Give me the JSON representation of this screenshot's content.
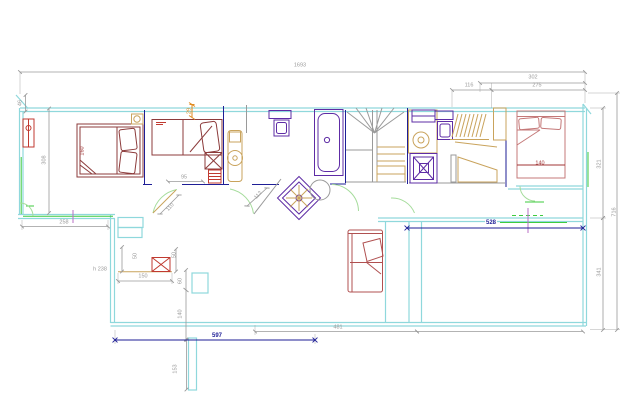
{
  "document": {
    "type": "architectural-floor-plan",
    "background": "#ffffff"
  },
  "palette": {
    "cyan": "#8fd8dc",
    "navy": "#1e1e96",
    "purple": "#5e2ca5",
    "maroon": "#8c3b3b",
    "bedpink": "#c47878",
    "red": "#c03a30",
    "tan": "#c9a35c",
    "tan_fill": "#e3d0a0",
    "green": "#3ecb3e",
    "green_arc": "#a5dc9b",
    "gray": "#9a9a9a",
    "orange": "#e08a1e",
    "magenta": "#b86fc6",
    "brown": "#7c3a2e",
    "sofa": "#b05050",
    "dark_red_text": "#a03535"
  },
  "dimensions": [
    {
      "text": "1693",
      "x": 300,
      "y": 66,
      "rot": 0,
      "color": "gray"
    },
    {
      "text": "302",
      "x": 533,
      "y": 78,
      "rot": 0,
      "color": "gray"
    },
    {
      "text": "116",
      "x": 469,
      "y": 86,
      "rot": 0,
      "color": "gray"
    },
    {
      "text": "275",
      "x": 537,
      "y": 86,
      "rot": 0,
      "color": "gray"
    },
    {
      "text": "46",
      "x": 21,
      "y": 103,
      "rot": -90,
      "color": "gray"
    },
    {
      "text": "308",
      "x": 45,
      "y": 160,
      "rot": -90,
      "color": "gray"
    },
    {
      "text": "160",
      "x": 83,
      "y": 151,
      "rot": -90,
      "color": "dark_red_text"
    },
    {
      "text": "29",
      "x": 190,
      "y": 111,
      "rot": -90,
      "color": "orange"
    },
    {
      "text": "95",
      "x": 184,
      "y": 178,
      "rot": 0,
      "color": "gray"
    },
    {
      "text": "110",
      "x": 171,
      "y": 208,
      "rot": -48,
      "color": "gray"
    },
    {
      "text": "112",
      "x": 259,
      "y": 196,
      "rot": -48,
      "color": "gray"
    },
    {
      "text": "258",
      "x": 64,
      "y": 223,
      "rot": 0,
      "color": "gray"
    },
    {
      "text": "h 238",
      "x": 100,
      "y": 270,
      "rot": 0,
      "color": "gray"
    },
    {
      "text": "50",
      "x": 136,
      "y": 256,
      "rot": -90,
      "color": "gray"
    },
    {
      "text": "50",
      "x": 175,
      "y": 255,
      "rot": -90,
      "color": "gray"
    },
    {
      "text": "150",
      "x": 143,
      "y": 277,
      "rot": 0,
      "color": "gray"
    },
    {
      "text": "60",
      "x": 181,
      "y": 281,
      "rot": -90,
      "color": "gray"
    },
    {
      "text": "140",
      "x": 181,
      "y": 314,
      "rot": -90,
      "color": "gray"
    },
    {
      "text": "153",
      "x": 176,
      "y": 369,
      "rot": -90,
      "color": "gray"
    },
    {
      "text": "597",
      "x": 217,
      "y": 336,
      "rot": 0,
      "color": "navy",
      "bold": true
    },
    {
      "text": "481",
      "x": 338,
      "y": 328,
      "rot": 0,
      "color": "gray"
    },
    {
      "text": "528",
      "x": 491,
      "y": 223,
      "rot": 0,
      "color": "navy",
      "bold": true
    },
    {
      "text": "140",
      "x": 540,
      "y": 164,
      "rot": 0,
      "color": "dark_red_text"
    },
    {
      "text": "321",
      "x": 600,
      "y": 164,
      "rot": -90,
      "color": "gray"
    },
    {
      "text": "341",
      "x": 600,
      "y": 272,
      "rot": -90,
      "color": "gray"
    },
    {
      "text": "716",
      "x": 615,
      "y": 212,
      "rot": -90,
      "color": "gray"
    }
  ]
}
